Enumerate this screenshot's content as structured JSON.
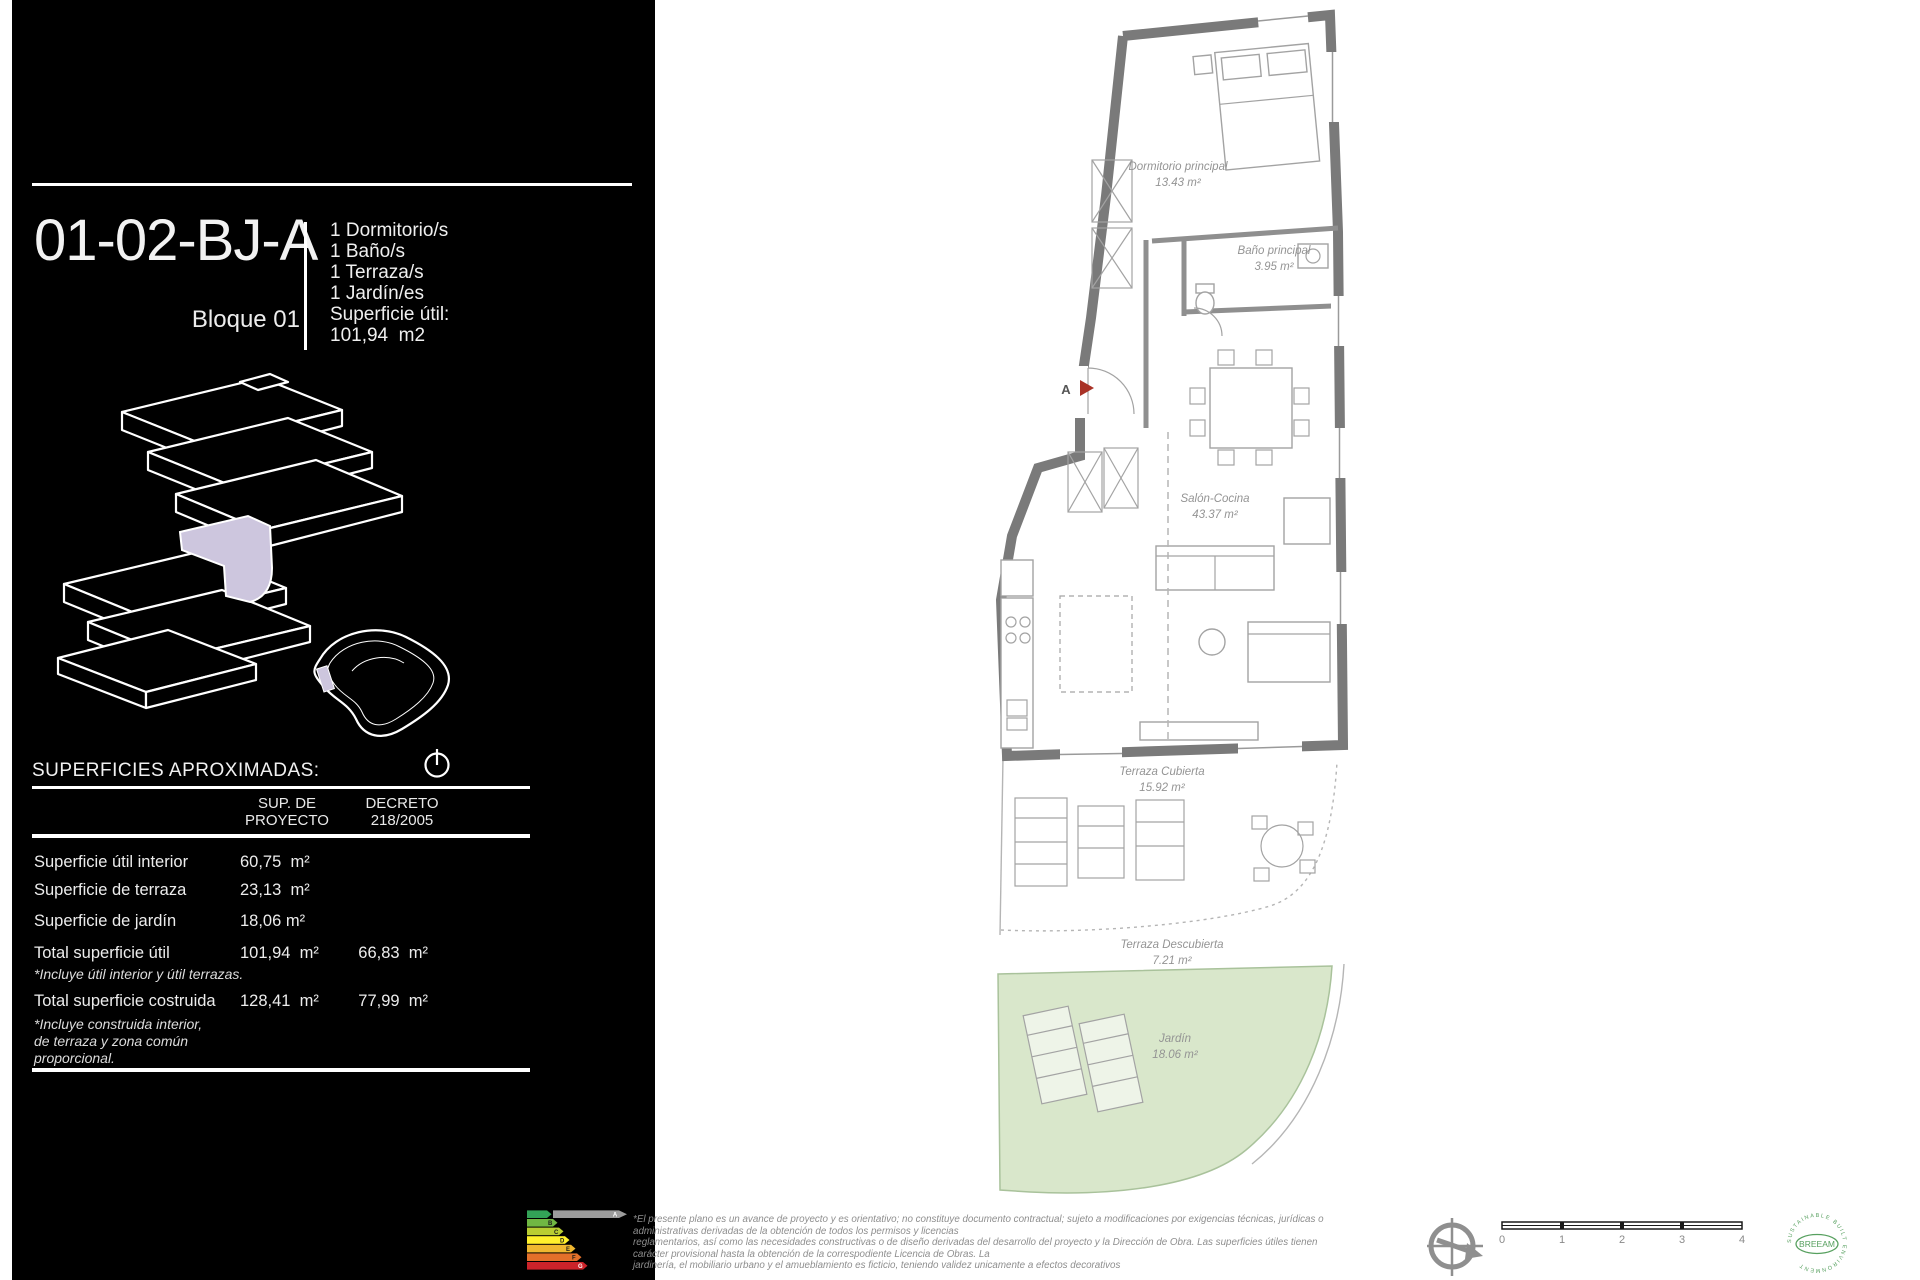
{
  "panel": {
    "unit_code": "01-02-BJ-A",
    "block": "Bloque 01",
    "features": [
      "1 Dormitorio/s",
      "1 Baño/s",
      "1 Terraza/s",
      "1 Jardín/es"
    ],
    "usable_label": "Superficie útil:",
    "usable_value": "101,94  m2",
    "surfaces_heading": "SUPERFICIES APROXIMADAS:",
    "table": {
      "header_proyecto_1": "SUP. DE",
      "header_proyecto_2": "PROYECTO",
      "header_decreto_1": "DECRETO",
      "header_decreto_2": "218/2005",
      "rows": [
        {
          "label": "Superficie útil interior",
          "proyecto": "60,75  m²",
          "decreto": ""
        },
        {
          "label": "Superficie de terraza",
          "proyecto": "23,13  m²",
          "decreto": ""
        },
        {
          "label": "Superficie de jardín",
          "proyecto": "18,06 m²",
          "decreto": ""
        },
        {
          "label": "Total superficie útil",
          "proyecto": "101,94  m²",
          "decreto": "66,83  m²",
          "note": "*Incluye útil interior y útil terrazas."
        },
        {
          "label": "Total superficie costruida",
          "proyecto": "128,41  m²",
          "decreto": "77,99  m²",
          "note": "*Incluye construida interior,",
          "note2": "de terraza y zona común",
          "note3": "proporcional."
        }
      ]
    }
  },
  "plan": {
    "rooms": [
      {
        "name": "Dormitorio principal",
        "area": "13.43 m²"
      },
      {
        "name": "Baño principal",
        "area": "3.95 m²"
      },
      {
        "name": "Salón-Cocina",
        "area": "43.37 m²"
      },
      {
        "name": "Terraza Cubierta",
        "area": "15.92 m²"
      },
      {
        "name": "Terraza Descubierta",
        "area": "7.21 m²"
      },
      {
        "name": "Jardín",
        "area": "18.06 m²"
      }
    ],
    "entry_label": "A"
  },
  "footer": {
    "disclaimer": [
      "*El presente plano es un avance de proyecto y es orientativo; no constituye documento contractual; sujeto a modificaciones por exigencias técnicas, jurídicas o",
      "administrativas derivadas de la obtención de todos los permisos y licencias",
      "reglamentarios, así como las necesidades constructivas o de diseño derivadas del desarrollo del proyecto y la Dirección de Obra. Las superficies útiles tienen",
      "carácter provisional hasta la obtención de la correspodiente Licencia de Obras. La",
      "jardinería, el mobiliario urbano y el amueblamiento es ficticio, teniendo validez unicamente a efectos decorativos"
    ],
    "energy": {
      "letters": [
        "A",
        "B",
        "C",
        "D",
        "E",
        "F",
        "G"
      ],
      "colors": [
        "#33a357",
        "#70b743",
        "#b9cd32",
        "#fff02c",
        "#efb730",
        "#e3702a",
        "#cc232a"
      ],
      "rating": "A"
    },
    "scale_ticks": [
      "0",
      "1",
      "2",
      "3",
      "4"
    ],
    "breeam": {
      "label": "BREEAM",
      "ring": "SUSTAINABLE BUILT ENVIRONMENT"
    }
  },
  "colors": {
    "panel_bg": "#000000",
    "highlight": "#cdc6de",
    "wall": "#7a7a7a",
    "garden_green": "#d9e7cb",
    "plan_label": "#949494",
    "entry_arrow_red": "#a93226",
    "breeam_green": "#57a05f"
  }
}
